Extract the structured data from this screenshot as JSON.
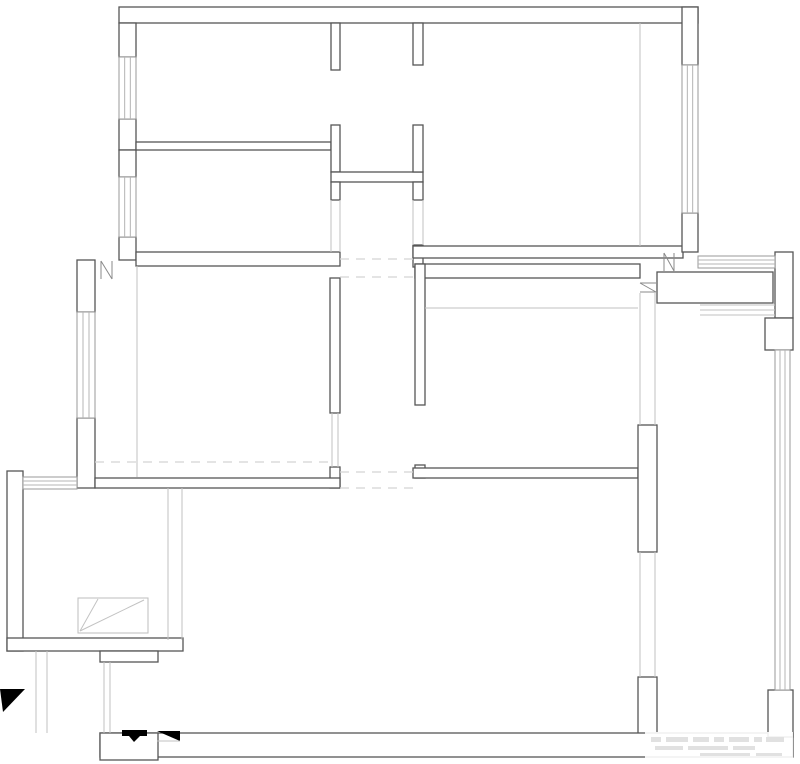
{
  "canvas": {
    "width": 800,
    "height": 764,
    "background": "#ffffff"
  },
  "colors": {
    "wall_outline": "#565656",
    "window_frame": "#9a9a9a",
    "light_line": "#c2c2c2",
    "dashed_line": "#d4d4d4",
    "door_mark": "#8a8a8a",
    "symbol_black": "#000000",
    "watermark_gray": "#e1e1e1"
  },
  "floorplan": {
    "description": "black-and-white architectural floor plan, unfurnished, no dimension text",
    "walls": [
      [
        119,
        7,
        579,
        16
      ],
      [
        119,
        23,
        17,
        34
      ],
      [
        119,
        119,
        17,
        31
      ],
      [
        119,
        150,
        17,
        27
      ],
      [
        119,
        237,
        17,
        23
      ],
      [
        136,
        142,
        195,
        8
      ],
      [
        136,
        252,
        204,
        14
      ],
      [
        331,
        23,
        9,
        47
      ],
      [
        331,
        125,
        9,
        47
      ],
      [
        331,
        172,
        92,
        10
      ],
      [
        331,
        182,
        9,
        18
      ],
      [
        413,
        23,
        10,
        42
      ],
      [
        413,
        125,
        10,
        47
      ],
      [
        413,
        182,
        10,
        18
      ],
      [
        413,
        245,
        10,
        22
      ],
      [
        413,
        246,
        270,
        12
      ],
      [
        415,
        264,
        225,
        14
      ],
      [
        682,
        7,
        16,
        58
      ],
      [
        682,
        213,
        16,
        39
      ],
      [
        657,
        272,
        116,
        31
      ],
      [
        775,
        252,
        18,
        66
      ],
      [
        765,
        318,
        28,
        32
      ],
      [
        77,
        260,
        18,
        52
      ],
      [
        77,
        418,
        18,
        70
      ],
      [
        330,
        278,
        10,
        135
      ],
      [
        330,
        467,
        10,
        21
      ],
      [
        95,
        478,
        245,
        10
      ],
      [
        415,
        264,
        10,
        141
      ],
      [
        415,
        465,
        10,
        13
      ],
      [
        413,
        468,
        225,
        10
      ],
      [
        638,
        425,
        19,
        127
      ],
      [
        638,
        677,
        19,
        60
      ],
      [
        7,
        471,
        16,
        180
      ],
      [
        7,
        638,
        176,
        13
      ],
      [
        100,
        651,
        58,
        11
      ],
      [
        100,
        733,
        693,
        24
      ],
      [
        100,
        733,
        58,
        27
      ],
      [
        768,
        690,
        25,
        47
      ]
    ],
    "windows": [
      {
        "x": 119,
        "y": 57,
        "w": 17,
        "h": 62,
        "dir": "v"
      },
      {
        "x": 119,
        "y": 177,
        "w": 17,
        "h": 60,
        "dir": "v"
      },
      {
        "x": 77,
        "y": 312,
        "w": 18,
        "h": 106,
        "dir": "v"
      },
      {
        "x": 682,
        "y": 65,
        "w": 16,
        "h": 148,
        "dir": "v"
      },
      {
        "x": 698,
        "y": 256,
        "w": 77,
        "h": 12,
        "dir": "h"
      },
      {
        "x": 775,
        "y": 350,
        "w": 15,
        "h": 340,
        "dir": "v"
      },
      {
        "x": 23,
        "y": 477,
        "w": 54,
        "h": 12,
        "dir": "h"
      }
    ],
    "light_lines": [
      [
        331,
        200,
        331,
        252
      ],
      [
        340,
        200,
        340,
        252
      ],
      [
        413,
        200,
        413,
        245
      ],
      [
        423,
        200,
        423,
        245
      ],
      [
        640,
        23,
        640,
        246
      ],
      [
        137,
        266,
        137,
        477
      ],
      [
        425,
        308,
        638,
        308
      ],
      [
        332,
        413,
        332,
        467
      ],
      [
        338,
        413,
        338,
        467
      ],
      [
        640,
        293,
        640,
        425
      ],
      [
        655,
        293,
        655,
        425
      ],
      [
        640,
        552,
        640,
        677
      ],
      [
        655,
        552,
        655,
        677
      ],
      [
        700,
        305,
        775,
        305
      ],
      [
        700,
        310,
        775,
        310
      ],
      [
        700,
        315,
        775,
        315
      ],
      [
        168,
        488,
        168,
        640
      ],
      [
        182,
        488,
        182,
        640
      ],
      [
        36,
        651,
        36,
        733
      ],
      [
        47,
        651,
        47,
        733
      ],
      [
        104,
        662,
        104,
        733
      ],
      [
        110,
        662,
        110,
        733
      ]
    ],
    "dashed_lines": [
      [
        340,
        259,
        413,
        259
      ],
      [
        340,
        277,
        413,
        277
      ],
      [
        340,
        472,
        413,
        472
      ],
      [
        340,
        488,
        413,
        488
      ],
      [
        95,
        462,
        330,
        462
      ]
    ],
    "door_marks": [
      {
        "lines": [
          [
            101,
            261,
            101,
            279
          ],
          [
            112,
            261,
            112,
            279
          ],
          [
            101,
            261,
            112,
            279
          ]
        ]
      },
      {
        "lines": [
          [
            664,
            253,
            664,
            271
          ],
          [
            674,
            253,
            674,
            271
          ],
          [
            664,
            253,
            674,
            271
          ]
        ]
      },
      {
        "lines": [
          [
            640,
            283,
            656,
            283
          ],
          [
            640,
            292,
            656,
            292
          ],
          [
            640,
            283,
            656,
            292
          ]
        ]
      }
    ],
    "fixture": {
      "outline": {
        "x": 78,
        "y": 598,
        "w": 70,
        "h": 35
      },
      "diagonals": [
        [
          80,
          631,
          144,
          600
        ],
        [
          80,
          631,
          98,
          599
        ]
      ]
    },
    "symbols": {
      "entry_arrow_points": "0,689 25,689 3,712",
      "threshold_bar": {
        "x": 122,
        "y": 730,
        "w": 25,
        "h": 6
      },
      "threshold_notch_points": "129,736 140,736 134,742",
      "ramp_points": "157,731 180,731 180,741",
      "ramp_baseline": [
        157,
        741,
        180,
        741
      ]
    },
    "watermark": {
      "legible": false,
      "underlay": {
        "x": 645,
        "y": 732,
        "w": 148,
        "h": 28
      },
      "blocks": [
        [
          651,
          737,
          10,
          5
        ],
        [
          666,
          737,
          22,
          5
        ],
        [
          693,
          737,
          16,
          5
        ],
        [
          714,
          737,
          10,
          5
        ],
        [
          729,
          737,
          20,
          5
        ],
        [
          754,
          737,
          8,
          5
        ],
        [
          766,
          737,
          18,
          5
        ],
        [
          655,
          746,
          28,
          4
        ],
        [
          688,
          746,
          40,
          4
        ],
        [
          733,
          746,
          22,
          4
        ],
        [
          700,
          753,
          50,
          3
        ],
        [
          756,
          753,
          26,
          3
        ]
      ]
    }
  }
}
